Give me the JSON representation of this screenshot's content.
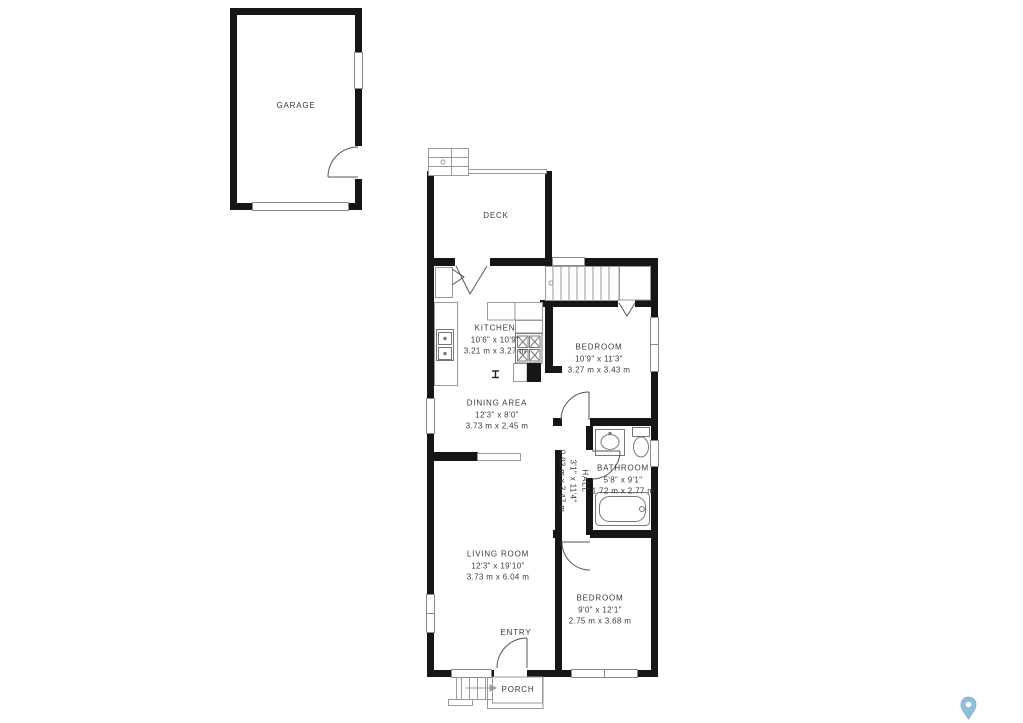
{
  "plan": {
    "rooms": [
      {
        "id": "garage",
        "name": "GARAGE"
      },
      {
        "id": "deck",
        "name": "DECK"
      },
      {
        "id": "kitchen",
        "name": "KITCHEN",
        "imperial": "10'6\" x 10'9\"",
        "metric": "3.21 m x 3.27 m"
      },
      {
        "id": "bedroom-1",
        "name": "BEDROOM",
        "imperial": "10'9\" x 11'3\"",
        "metric": "3.27 m x 3.43 m"
      },
      {
        "id": "dining-area",
        "name": "DINING AREA",
        "imperial": "12'3\" x 8'0\"",
        "metric": "3.73 m x 2.45 m"
      },
      {
        "id": "hall",
        "name": "HALL",
        "imperial": "3'1\" x 11'4\"",
        "metric": "0.93 m x 3.47 m"
      },
      {
        "id": "bathroom",
        "name": "BATHROOM",
        "imperial": "5'8\" x 9'1\"",
        "metric": "1.72 m x 2.77 m"
      },
      {
        "id": "living-room",
        "name": "LIVING ROOM",
        "imperial": "12'3\" x 19'10\"",
        "metric": "3.73 m x 6.04 m"
      },
      {
        "id": "bedroom-2",
        "name": "BEDROOM",
        "imperial": "9'0\" x 12'1\"",
        "metric": "2.75 m x 3.68 m"
      },
      {
        "id": "entry",
        "name": "ENTRY"
      },
      {
        "id": "porch",
        "name": "PORCH"
      }
    ],
    "colors": {
      "wall": "#161616",
      "thin_line": "#9a9a9a",
      "door_line": "#555555",
      "label_text": "#3a3a3a",
      "pin_blue": "#8cc0db"
    },
    "icons": {
      "watermark": "location-pin-icon"
    }
  }
}
